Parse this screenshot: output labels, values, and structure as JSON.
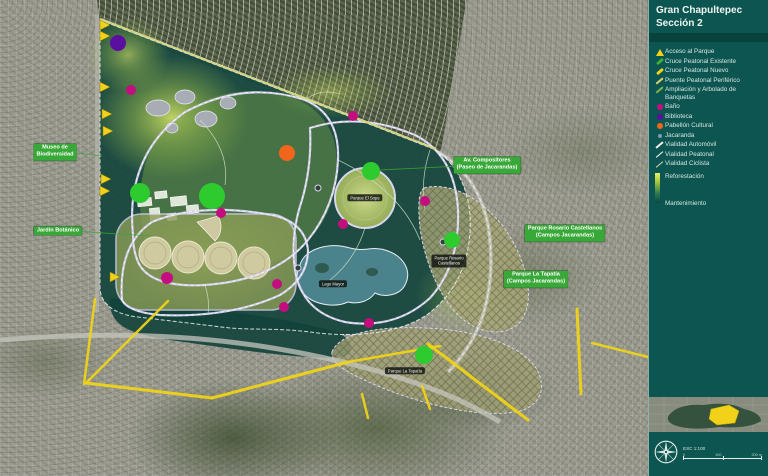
{
  "panel": {
    "title_line1": "Gran Chapultepec",
    "title_line2": "Sección 2",
    "legend": [
      {
        "id": "acceso-al-parque",
        "label": "Acceso al Parque",
        "icon": "triangle",
        "color": "#f2d11b"
      },
      {
        "id": "cruce-peatonal-existente",
        "label": "Cruce Peatonal Existente",
        "icon": "stroke",
        "color": "#3fae3f"
      },
      {
        "id": "cruce-peatonal-nuevo",
        "label": "Cruce Peatonal Nuevo",
        "icon": "stroke",
        "color": "#f2d11b"
      },
      {
        "id": "puente-peatonal-periferico",
        "label": "Puente Peatonal Periférico",
        "icon": "stroke-thin",
        "color": "#d9cf6e"
      },
      {
        "id": "ampliacion-y-arbolado-de-banquetas",
        "label": "Ampliación y Arbolado de Banquetas",
        "icon": "stroke-thin",
        "color": "#7cb24e"
      },
      {
        "id": "bano",
        "label": "Baño",
        "icon": "dot",
        "color": "#c40d7e"
      },
      {
        "id": "biblioteca",
        "label": "Biblioteca",
        "icon": "dot",
        "color": "#5a0fa0"
      },
      {
        "id": "pabellon-cultural",
        "label": "Pabellón Cultural",
        "icon": "dot",
        "color": "#f2661b"
      },
      {
        "id": "jacaranda",
        "label": "Jacaranda",
        "icon": "dot-small",
        "color": "#93a7c9"
      },
      {
        "id": "vialidad-automovil",
        "label": "Vialidad Automóvil",
        "icon": "line",
        "color": "#f0f0f0"
      },
      {
        "id": "vialidad-peatonal",
        "label": "Vialidad Peatonal",
        "icon": "line-thin",
        "color": "#ffffff"
      },
      {
        "id": "vialidad-ciclista",
        "label": "Vialidad Ciclista",
        "icon": "line-thin",
        "color": "#cfd8c0"
      }
    ],
    "reforestation_label": "Reforestación",
    "maintenance_label": "Mantenimiento",
    "scale_text": "ESC 1:100",
    "scale_ticks": [
      "0",
      "100",
      "200 m"
    ]
  },
  "map": {
    "colors": {
      "access": "#f2d11b",
      "road": "#f2d515",
      "bath": "#c40d7e",
      "library": "#5a0fa0",
      "pavilion": "#f2661b",
      "jacaranda_green": "#2ecb2e",
      "label_green": "#38a838"
    },
    "green_labels": [
      {
        "id": "museo-de-biodiversidad",
        "x": 55,
        "y": 152,
        "lines": [
          "Museo de",
          "Biodiversidad"
        ]
      },
      {
        "id": "jardin-botanico",
        "x": 58,
        "y": 231,
        "lines": [
          "Jardín Botánico"
        ]
      },
      {
        "id": "av-compositores",
        "x": 487,
        "y": 165,
        "lines": [
          "Av. Compositores",
          "(Paseo de Jacarandas)"
        ]
      },
      {
        "id": "parque-rosario-castellanos",
        "x": 565,
        "y": 233,
        "lines": [
          "Parque Rosario Castellanos",
          "(Campos Jacarandas)"
        ]
      },
      {
        "id": "parque-la-tapatia",
        "x": 536,
        "y": 279,
        "lines": [
          "Parque La Tapatía",
          "(Campos Jacarandas)"
        ]
      }
    ],
    "dark_pills": [
      {
        "id": "parque-el-sope",
        "x": 365,
        "y": 198,
        "lines": [
          "Parque El Sope"
        ]
      },
      {
        "id": "lago-mayor",
        "x": 333,
        "y": 284,
        "lines": [
          "Lago Mayor"
        ]
      },
      {
        "id": "parque-rosario-castellanos-pill",
        "x": 449,
        "y": 261,
        "lines": [
          "Parque Rosario",
          "Castellanos"
        ]
      },
      {
        "id": "parque-la-tapatia-pill",
        "x": 405,
        "y": 371,
        "lines": [
          "Parque La Tapatía"
        ]
      }
    ],
    "markers": {
      "library": [
        {
          "x": 118,
          "y": 43,
          "r": 8
        }
      ],
      "pavilion": [
        {
          "x": 287,
          "y": 153,
          "r": 8
        }
      ],
      "bath": [
        {
          "x": 131,
          "y": 90,
          "r": 5
        },
        {
          "x": 353,
          "y": 116,
          "r": 5
        },
        {
          "x": 221,
          "y": 213,
          "r": 5
        },
        {
          "x": 425,
          "y": 201,
          "r": 5
        },
        {
          "x": 343,
          "y": 224,
          "r": 5
        },
        {
          "x": 167,
          "y": 278,
          "r": 6
        },
        {
          "x": 277,
          "y": 284,
          "r": 5
        },
        {
          "x": 284,
          "y": 307,
          "r": 5
        },
        {
          "x": 369,
          "y": 323,
          "r": 5
        }
      ],
      "jacaranda": [
        {
          "x": 212,
          "y": 196,
          "r": 13
        },
        {
          "x": 140,
          "y": 193,
          "r": 10
        },
        {
          "x": 371,
          "y": 171,
          "r": 9
        },
        {
          "x": 452,
          "y": 240,
          "r": 8
        },
        {
          "x": 424,
          "y": 355,
          "r": 9
        }
      ]
    },
    "access_arrows": [
      {
        "x": 100,
        "y": 25
      },
      {
        "x": 100,
        "y": 36
      },
      {
        "x": 100,
        "y": 87
      },
      {
        "x": 102,
        "y": 114
      },
      {
        "x": 103,
        "y": 131
      },
      {
        "x": 101,
        "y": 179
      },
      {
        "x": 100,
        "y": 191
      },
      {
        "x": 110,
        "y": 277
      }
    ],
    "road_highlights": [
      [
        95,
        299,
        84,
        384,
        2.5
      ],
      [
        168,
        301,
        86,
        383,
        2.5
      ],
      [
        86,
        383,
        212,
        398,
        3
      ],
      [
        212,
        398,
        348,
        362,
        3
      ],
      [
        348,
        362,
        440,
        346,
        2.5
      ],
      [
        428,
        344,
        528,
        420,
        3
      ],
      [
        577,
        309,
        581,
        394,
        3
      ],
      [
        592,
        343,
        648,
        357,
        2.5
      ],
      [
        362,
        394,
        368,
        418,
        2.5
      ],
      [
        422,
        386,
        430,
        409,
        2.5
      ]
    ],
    "leader_lines": [
      [
        68,
        152,
        102,
        156
      ],
      [
        73,
        231,
        150,
        236
      ],
      [
        380,
        170,
        461,
        166
      ]
    ]
  }
}
